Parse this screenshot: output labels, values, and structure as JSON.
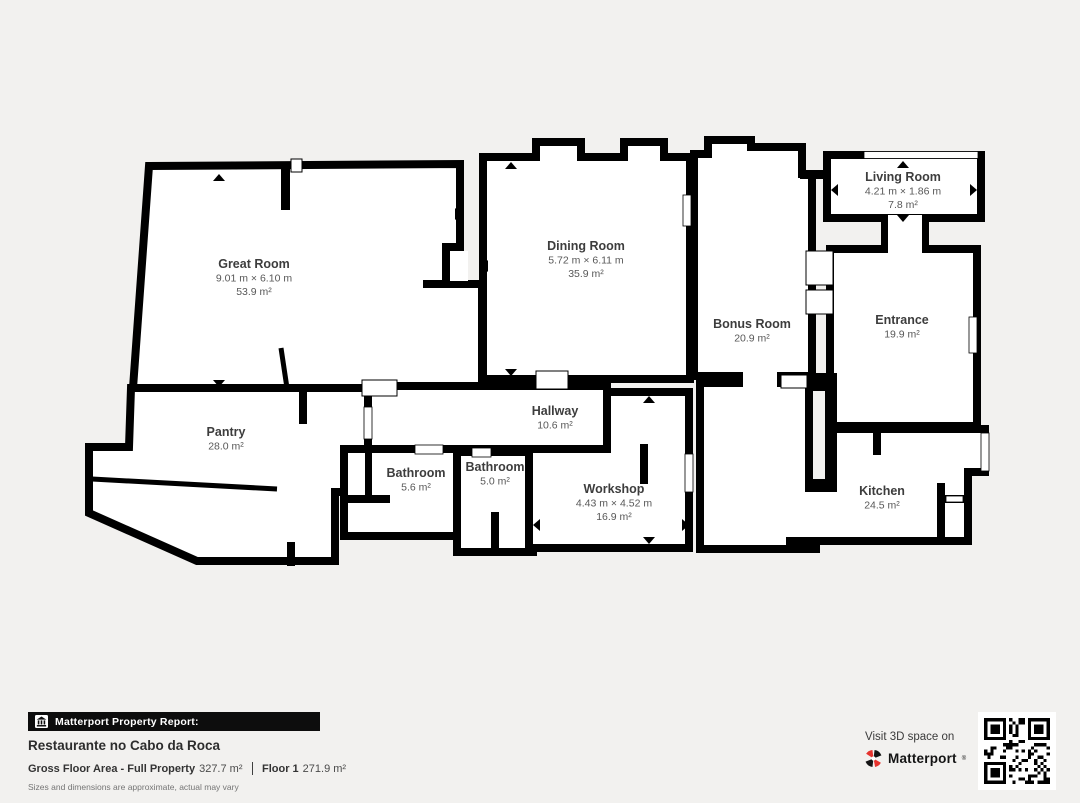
{
  "colors": {
    "background": "#f2f1ef",
    "wall": "#000000",
    "floor": "#ffffff",
    "accent_red": "#e5332e"
  },
  "rooms": [
    {
      "name": "Great Room",
      "dimensions": "9.01 m × 6.10 m",
      "area": "53.9 m²",
      "label_x": 254,
      "label_y": 260
    },
    {
      "name": "Dining Room",
      "dimensions": "5.72 m × 6.11 m",
      "area": "35.9 m²",
      "label_x": 586,
      "label_y": 242
    },
    {
      "name": "Bonus Room",
      "dimensions": null,
      "area": "20.9 m²",
      "label_x": 752,
      "label_y": 320
    },
    {
      "name": "Living Room",
      "dimensions": "4.21 m × 1.86 m",
      "area": "7.8 m²",
      "label_x": 903,
      "label_y": 173
    },
    {
      "name": "Entrance",
      "dimensions": null,
      "area": "19.9 m²",
      "label_x": 902,
      "label_y": 316
    },
    {
      "name": "Pantry",
      "dimensions": null,
      "area": "28.0 m²",
      "label_x": 226,
      "label_y": 428
    },
    {
      "name": "Hallway",
      "dimensions": null,
      "area": "10.6 m²",
      "label_x": 555,
      "label_y": 407
    },
    {
      "name": "Bathroom",
      "dimensions": null,
      "area": "5.6 m²",
      "label_x": 416,
      "label_y": 469
    },
    {
      "name": "Bathroom",
      "dimensions": null,
      "area": "5.0 m²",
      "label_x": 495,
      "label_y": 463
    },
    {
      "name": "Workshop",
      "dimensions": "4.43 m × 4.52 m",
      "area": "16.9 m²",
      "label_x": 614,
      "label_y": 485
    },
    {
      "name": "Kitchen",
      "dimensions": null,
      "area": "24.5 m²",
      "label_x": 882,
      "label_y": 487
    }
  ],
  "footer": {
    "report_label": "Matterport Property Report:",
    "property_name": "Restaurante no Cabo da Roca",
    "gross_floor_label": "Gross Floor Area - Full Property",
    "gross_floor_value": "327.7 m²",
    "floor_label": "Floor 1",
    "floor_value": "271.9 m²",
    "disclaimer": "Sizes and dimensions are approximate, actual may vary"
  },
  "visit": {
    "line1": "Visit 3D space on",
    "brand": "Matterport"
  }
}
